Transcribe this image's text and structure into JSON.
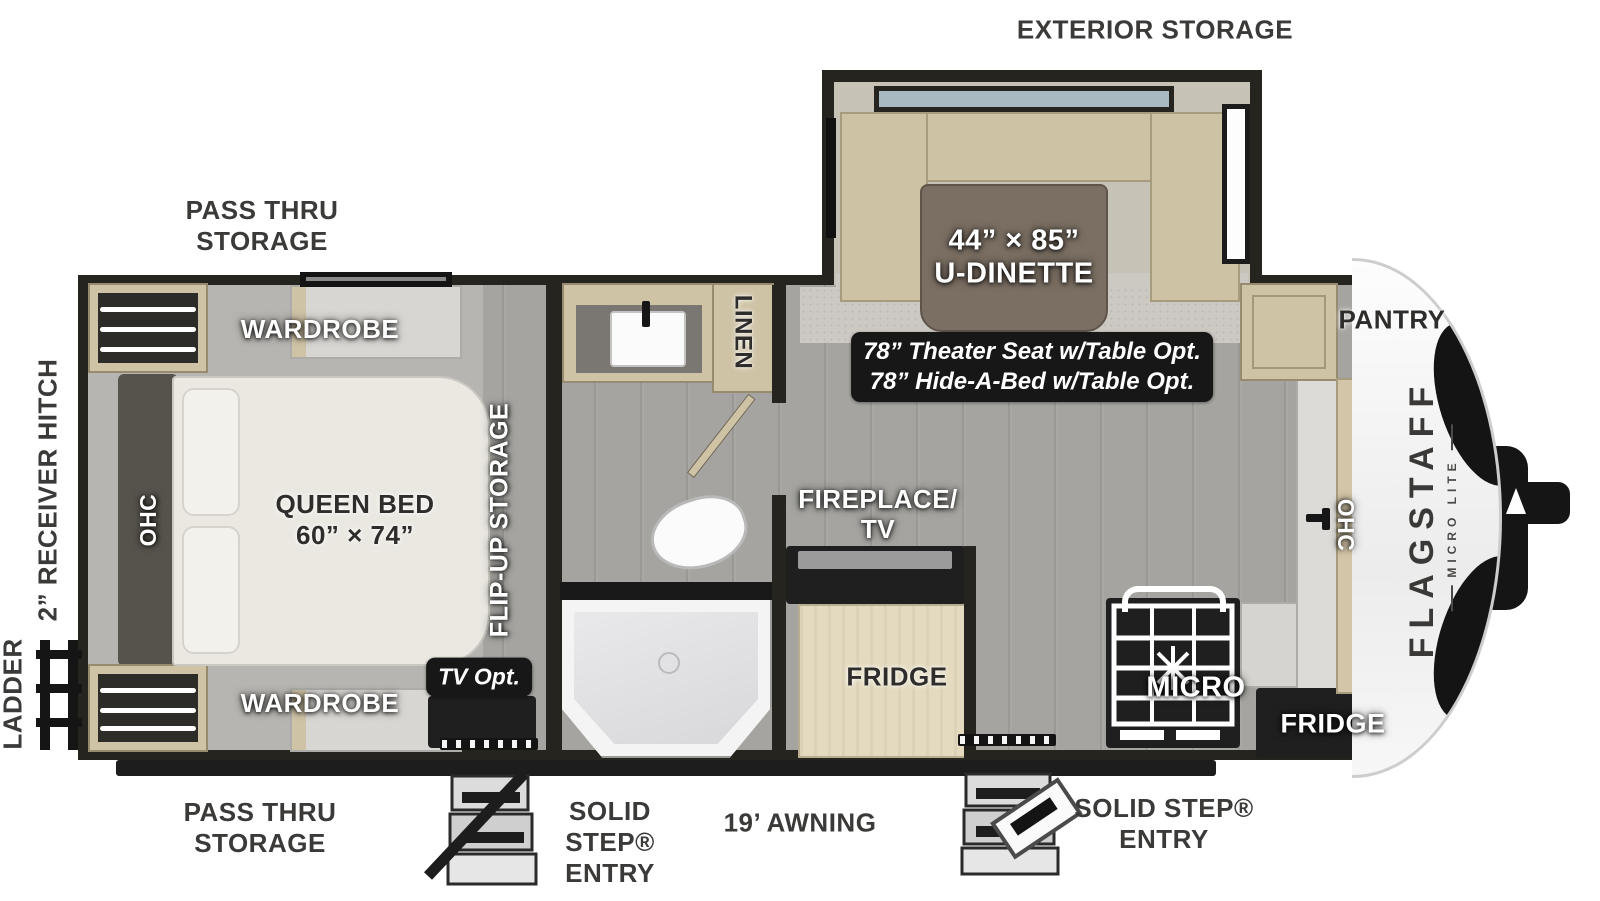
{
  "diagram": {
    "type": "rv-floorplan",
    "brand": "FLAGSTAFF",
    "brand_sub": "MICRO LITE"
  },
  "labels": {
    "exterior_storage": "EXTERIOR STORAGE",
    "pass_thru_storage_top": "PASS THRU STORAGE",
    "pass_thru_storage_bottom": "PASS THRU STORAGE",
    "receiver_hitch": "2” RECEIVER HITCH",
    "ladder": "LADDER",
    "awning": "19’ AWNING",
    "solid_step_entry_left": "SOLID STEP® ENTRY",
    "solid_step_entry_right": "SOLID STEP® ENTRY",
    "wardrobe_top": "WARDROBE",
    "wardrobe_bottom": "WARDROBE",
    "ohc_left": "OHC",
    "ohc_right": "OHC",
    "queen_bed_line1": "QUEEN BED",
    "queen_bed_line2": "60” × 74”",
    "flip_up_storage": "FLIP-UP STORAGE",
    "linen": "LINEN",
    "tv_opt": "TV Opt.",
    "fireplace_tv": "FIREPLACE/ TV",
    "fridge_island": "FRIDGE",
    "micro": "MICRO",
    "pantry": "PANTRY",
    "fridge_front": "FRIDGE",
    "dinette_line1": "44” × 85”",
    "dinette_line2": "U-DINETTE",
    "option_line1": "78” Theater Seat w/Table Opt.",
    "option_line2": "78” Hide-A-Bed w/Table Opt."
  },
  "colors": {
    "wall": "#26241f",
    "floor_wood": "#a5a4a0",
    "bedroom_floor": "#b7b5b1",
    "cabinet_wood": "#cfc3a6",
    "dinette_cushion": "#cdc2a4",
    "dinette_table": "#7b6f63",
    "note_background": "#171717",
    "label_dark": "#3b3a38",
    "label_light": "#ffffff"
  }
}
